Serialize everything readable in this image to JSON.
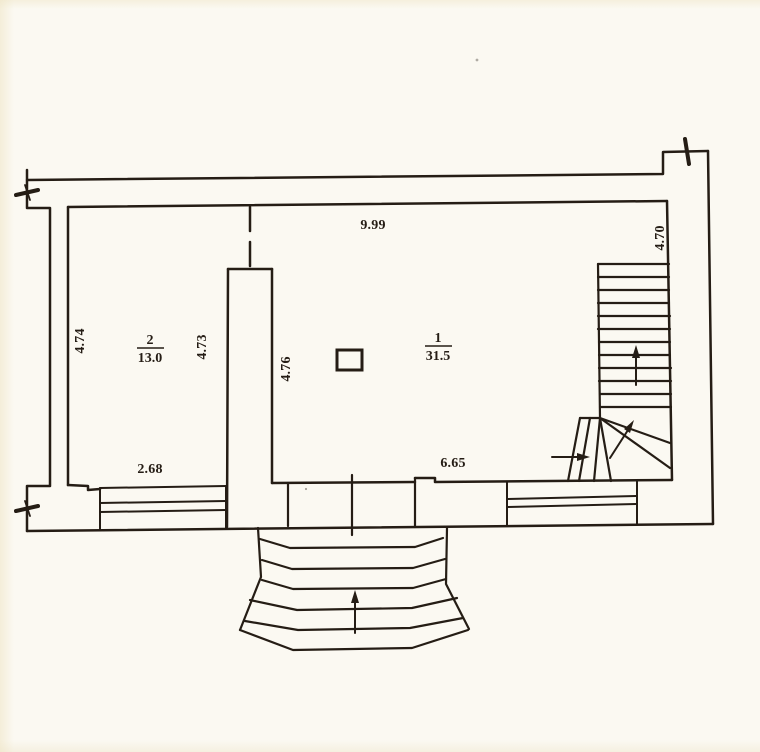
{
  "plan": {
    "colors": {
      "paper": "#fbf9f2",
      "ink": "#251d15"
    },
    "dimensions": {
      "top_width": "9.99",
      "left_height": "4.74",
      "room2_right_height": "4.73",
      "partition_right_height": "4.76",
      "right_height": "4.70",
      "bottom_left_width": "2.68",
      "bottom_right_width": "6.65"
    },
    "rooms": [
      {
        "number": "1",
        "area": "31.5"
      },
      {
        "number": "2",
        "area": "13.0"
      }
    ]
  }
}
